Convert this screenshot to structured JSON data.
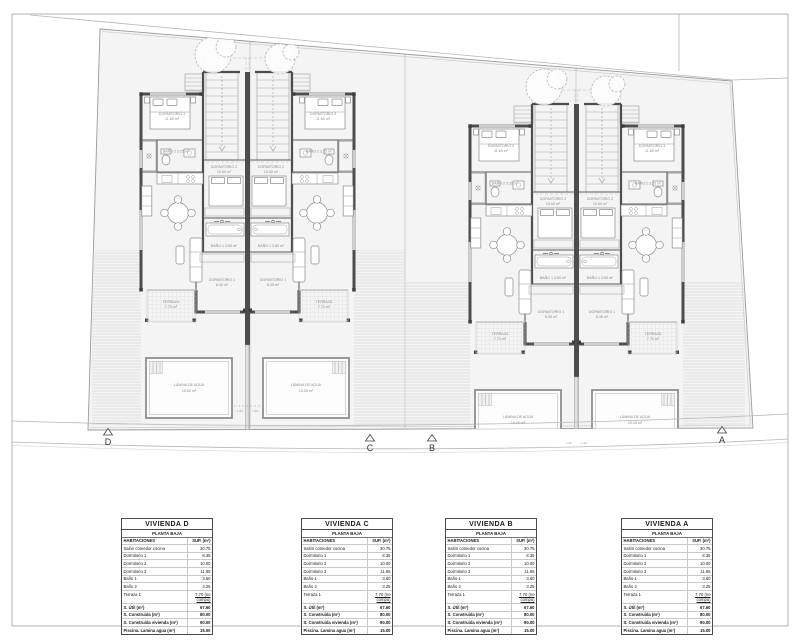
{
  "plan": {
    "section_markers": [
      "D",
      "C",
      "B",
      "A"
    ],
    "room_labels": {
      "dorm3": "DORMITORIO 3",
      "dorm3_area": "11.65 m²",
      "dorm2": "DORMITORIO 2",
      "dorm2_area": "10.00 m²",
      "dorm1": "DORMITORIO 1",
      "dorm1_area": "8.35 m²",
      "bano1": "BAÑO 1  3.60 m²",
      "bano2": "BAÑO 2  3.25 m²",
      "terraza": "TERRAZA",
      "terraza_area": "7.70 m²",
      "pool": "LÁMINA DE AGUA",
      "pool_area": "15.00 m²",
      "drain": "L-90"
    },
    "colors": {
      "wall": "#4d4d4d",
      "plot_fill": "#f4f4f4",
      "boundary": "#9a9a9a"
    }
  },
  "tables": {
    "units": [
      "VIVIENDA D",
      "VIVIENDA C",
      "VIVIENDA B",
      "VIVIENDA A"
    ],
    "subtitle": "PLANTA BAJA",
    "col_room": "HABITACIONES",
    "col_sup": "SUP. (m²)",
    "rows": [
      {
        "label": "Salón comedor cocina",
        "value": "30.75"
      },
      {
        "label": "Dormitorio 1",
        "value": "8.35"
      },
      {
        "label": "Dormitorio 2",
        "value": "10.00"
      },
      {
        "label": "Dormitorio 3",
        "value": "11.65"
      },
      {
        "label": "Baño 1",
        "value": "3.60"
      },
      {
        "label": "Baño 2",
        "value": "3.25"
      },
      {
        "label": "Terraza 1",
        "value": "7.70 (no compu)"
      }
    ],
    "summary": [
      {
        "label": "S. Útil (m²)",
        "value": "67.60"
      },
      {
        "label": "S. Construida (m²)",
        "value": "80.00"
      },
      {
        "label": "S. Construida vivienda (m²)",
        "value": "90.00"
      },
      {
        "label": "Piscina. Lamina agua (m²)",
        "value": "15.00"
      }
    ]
  }
}
